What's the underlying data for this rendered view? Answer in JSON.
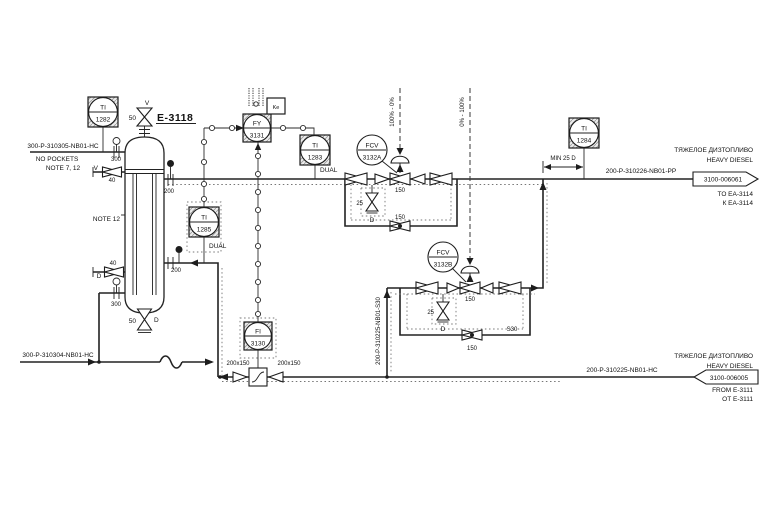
{
  "equipment": {
    "tag": "E-3118",
    "note12": "NOTE 12"
  },
  "instruments": {
    "ti1282": {
      "line1": "TI",
      "line2": "1282"
    },
    "ti1283": {
      "line1": "TI",
      "line2": "1283",
      "sub": "DUAL"
    },
    "ti1284": {
      "line1": "TI",
      "line2": "1284"
    },
    "ti1285": {
      "line1": "TI",
      "line2": "1285",
      "sub": "DUAL"
    },
    "fy3131": {
      "line1": "FY",
      "line2": "3131",
      "aux": "Ke"
    },
    "fi3130": {
      "line1": "FI",
      "line2": "3130"
    },
    "fcv3132a": {
      "line1": "FCV",
      "line2": "3132A"
    },
    "fcv3132b": {
      "line1": "FCV",
      "line2": "3132B"
    }
  },
  "pipes": {
    "inlet_top": {
      "label": "300-P-310305-NB01-HC",
      "note1": "NO POCKETS",
      "note2": "NOTE 7, 12"
    },
    "bottom_out": {
      "label": "300-P-310304-NB01-HC"
    },
    "product": {
      "label": "200-P-310226-NB01-PP",
      "min_run": "MIN 25 D"
    },
    "diesel_in": {
      "label": "200-P-310225-NB01-HC"
    },
    "s30": {
      "label": "200-P-310225-NB01-S30",
      "spec": "S30"
    }
  },
  "sizes": {
    "n300": "300",
    "n200": "200",
    "n150": "150",
    "n50": "50",
    "n40": "40",
    "n25": "25",
    "reducer": "200x150"
  },
  "marks": {
    "vent": "V",
    "drain": "D"
  },
  "signals": {
    "range_a": "100% - 0%",
    "range_b": "0% - 100%"
  },
  "connectors": {
    "outgoing": {
      "id": "3100-006061",
      "medium_ru": "ТЯЖЕЛОЕ ДИЗТОПЛИВО",
      "medium_en": "HEAVY DIESEL",
      "to_en": "TO EA-3114",
      "to_ru": "К EA-3114"
    },
    "incoming": {
      "id": "3100-006005",
      "medium_ru": "ТЯЖЕЛОЕ ДИЗТОПЛИВО",
      "medium_en": "HEAVY DIESEL",
      "from_en": "FROM E-3111",
      "from_ru": "ОТ E-3111"
    }
  },
  "colors": {
    "line": "#222222",
    "trace": "#767676",
    "hatch": "#9a9a9a"
  }
}
